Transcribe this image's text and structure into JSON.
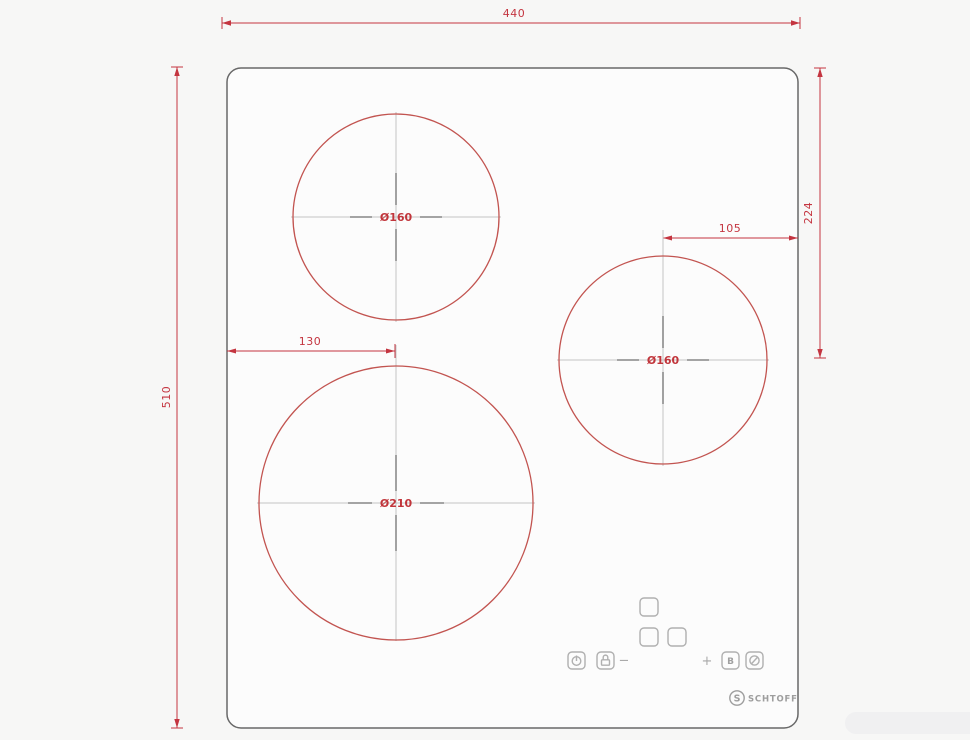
{
  "drawing": {
    "description": "Built-in induction hob cutout dimension drawing with three cooking zones",
    "panel": {
      "shape": "rounded-rectangle"
    },
    "dimensions": {
      "top_width": "440",
      "left_height": "510",
      "right_offset": "224",
      "zone_right_offset": "105",
      "zone_large_offset": "130"
    },
    "zones": [
      {
        "id": "zone-top",
        "label": "Ø160"
      },
      {
        "id": "zone-right",
        "label": "Ø160"
      },
      {
        "id": "zone-bottom-large",
        "label": "Ø210"
      }
    ],
    "controls": {
      "minus": "−",
      "plus": "+",
      "booster": "B"
    },
    "brand": {
      "monogram": "S",
      "name": "SCHTOFF"
    }
  },
  "colors": {
    "background": "#f7f7f6",
    "dimension_red": "#c43540",
    "zone_red": "#c25450",
    "panel_outline": "#686868",
    "crosshair_gray": "#c3c3c3",
    "centermark_gray": "#979797",
    "control_gray": "#b0b0b0",
    "brand_gray": "#9e9e9e"
  }
}
